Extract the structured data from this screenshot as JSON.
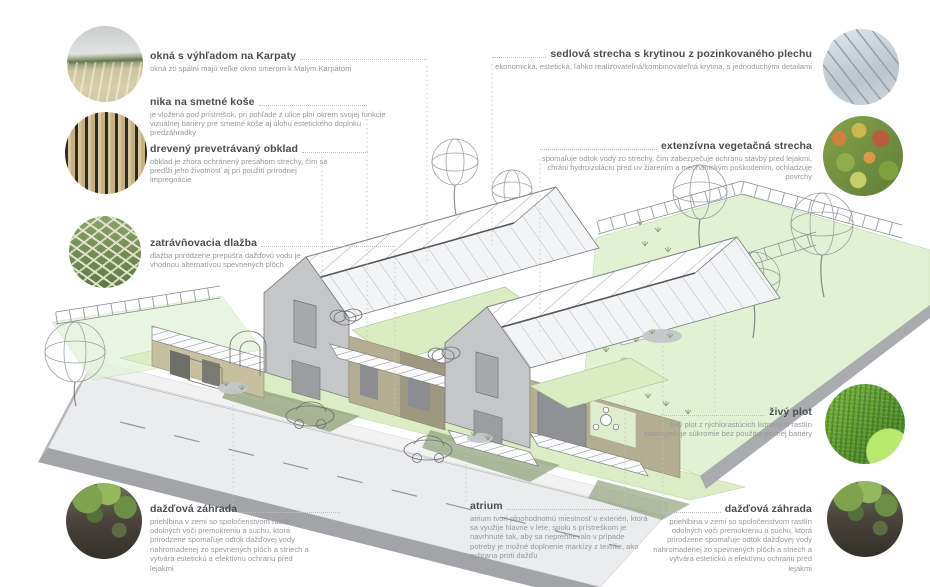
{
  "colors": {
    "title_text": "#4c4d4f",
    "body_text": "#97999c",
    "leader_dotted": "#c4c6c8",
    "lawn_green": "#e2f1d3",
    "front_garden_green": "#dcedc6",
    "green_roof": "#d9ecc2",
    "roof_white": "#fdfdfe",
    "wall_gray": "#c5c6c8",
    "wood_tan": "#b3ad92",
    "road_gray": "#ebeced"
  },
  "photos": [
    {
      "name": "photo-karpaty-view"
    },
    {
      "name": "photo-wood-cladding"
    },
    {
      "name": "photo-grass-pavers"
    },
    {
      "name": "photo-rain-garden-left"
    },
    {
      "name": "photo-metal-roof"
    },
    {
      "name": "photo-green-roof"
    },
    {
      "name": "photo-hedge"
    },
    {
      "name": "photo-rain-garden-right"
    }
  ],
  "labels": {
    "okna": {
      "title": "okná s výhľadom na Karpaty",
      "desc": "okná zo spální majú veľké okno smerom k Malým Karpatom"
    },
    "nika": {
      "title": "nika na smetné koše",
      "desc": "je vložená pod prístrešok, pri pohľade z ulice plní okrem svojej funkcie vizuálnej bariéry pre smetné koše aj úlohu estetického doplnku predzáhradky"
    },
    "dreveny": {
      "title": "drevený prevetrávaný obklad",
      "desc": "obklad je zhora ochránený presahom strechy, čím sa predĺži jeho životnosť aj pri použití prírodnej impregnácie"
    },
    "zatravnovacia": {
      "title": "zatrávňovacia dlažba",
      "desc": "dlažba prirodzene prepúšťa dažďovú vodu je vhodnou alternatívou spevnených plôch"
    },
    "dazdova_lava": {
      "title": "dažďová záhrada",
      "desc": "priehlbina v zemi so spoločenstvom rastlín odolných voči premokreniu a suchu, ktorá prirodzene spomaľuje odtok dažďovej vody nahromadenej zo spevnených plôch a striech a vytvára estetickú a efektívnu ochranu pred lejakmi"
    },
    "sedlova": {
      "title": "sedlová strecha s krytinou z pozinkovaného plechu",
      "desc": "ekonomická, estetická, ľahko realizovateľná/kombinovateľná krytina, s jednoduchými detailami"
    },
    "extenzivna": {
      "title": "extenzívna vegetačná strecha",
      "desc": "spomaľuje odtok vody zo strechy, čím zabezpečuje ochranu stavby pred lejakmi, chráni hydroizoláciu pred uv žiarením a mechanickým poškodením, ochladzuje povrchy"
    },
    "zivy_plot": {
      "title": "živý plot",
      "desc": "živý plot z rýchlorastúcich listnatých rastlín zabezpečuje súkromie bez použitia pevnej bariéry"
    },
    "dazdova_prava": {
      "title": "dažďová záhrada",
      "desc": "priehlbina v zemi so spoločenstvom rastlín odolných voči premokreniu a suchu, ktorá prirodzene spomaľuje odtok dažďovej vody nahromadenej zo spevnených plôch a striech a vytvára estetickú a efektívnu ochranu pred lejakmi"
    },
    "atrium": {
      "title": "atrium",
      "desc": "atrium tvorí plnohodnotnú miestnosť v exteriéri, ktorá sa využije hlavne v lete, spolu s prístreškom je navrhnuté tak, aby sa neprehrievalo v prípade potreby je možné doplnenie markízy z textílie, ako ochrana proti dažďu"
    }
  }
}
